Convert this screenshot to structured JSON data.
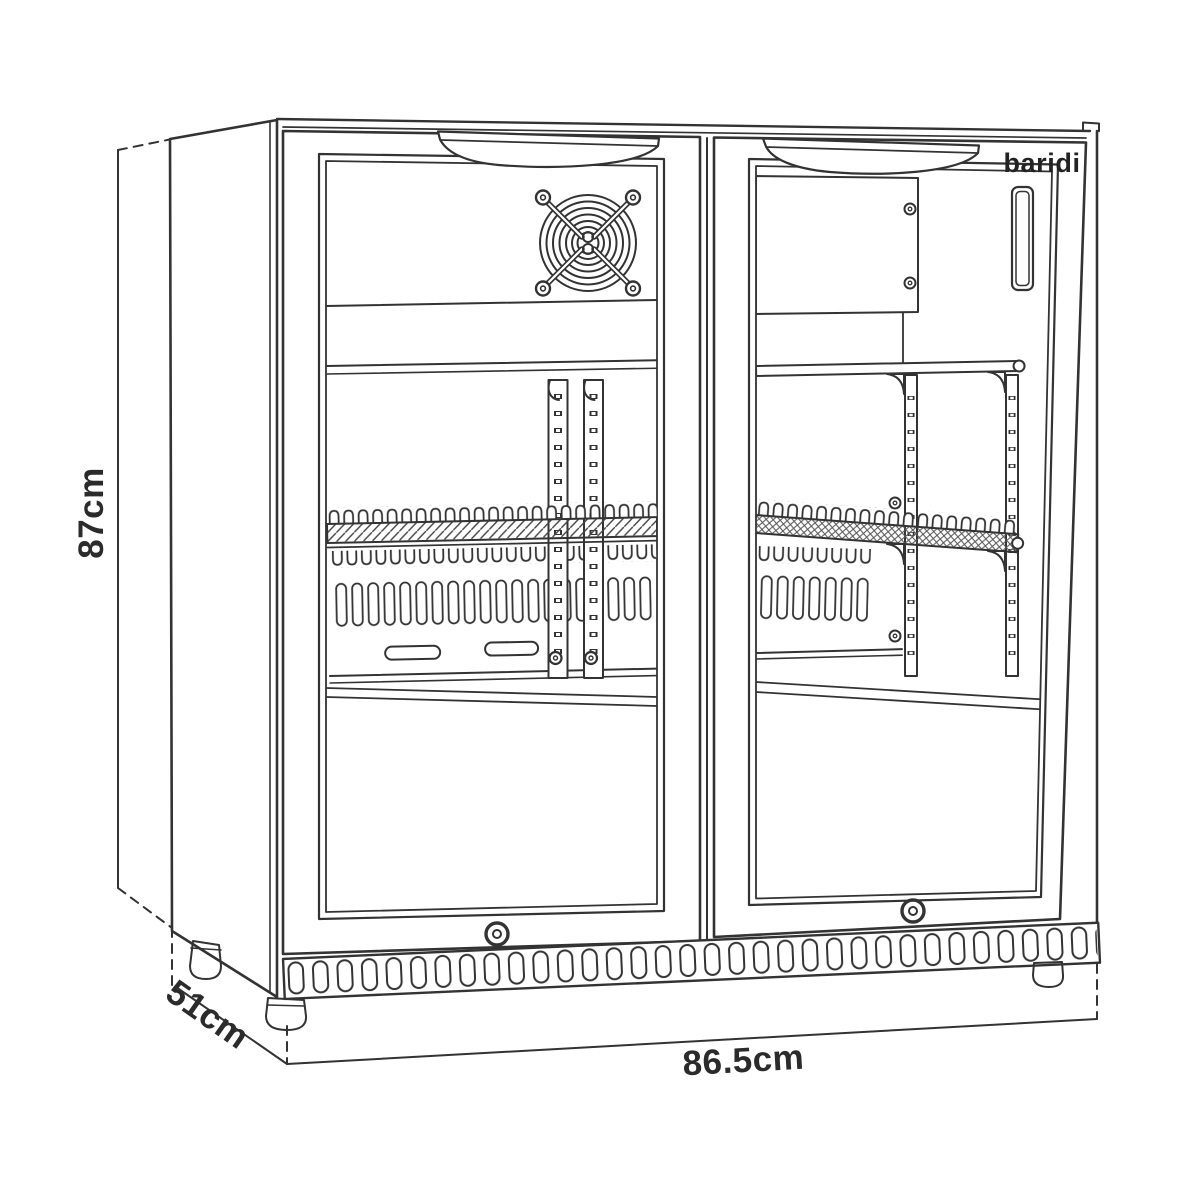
{
  "brand": {
    "logo": "baridi"
  },
  "dimensions": {
    "height": "87cm",
    "depth": "51cm",
    "width": "86.5cm"
  },
  "colors": {
    "dimension_line": "#7eaede",
    "line_art": "#333333",
    "background": "#ffffff"
  },
  "icons": {
    "fan": "fan-grille-icon",
    "lock": "door-lock-icon",
    "screw": "screw-icon"
  }
}
